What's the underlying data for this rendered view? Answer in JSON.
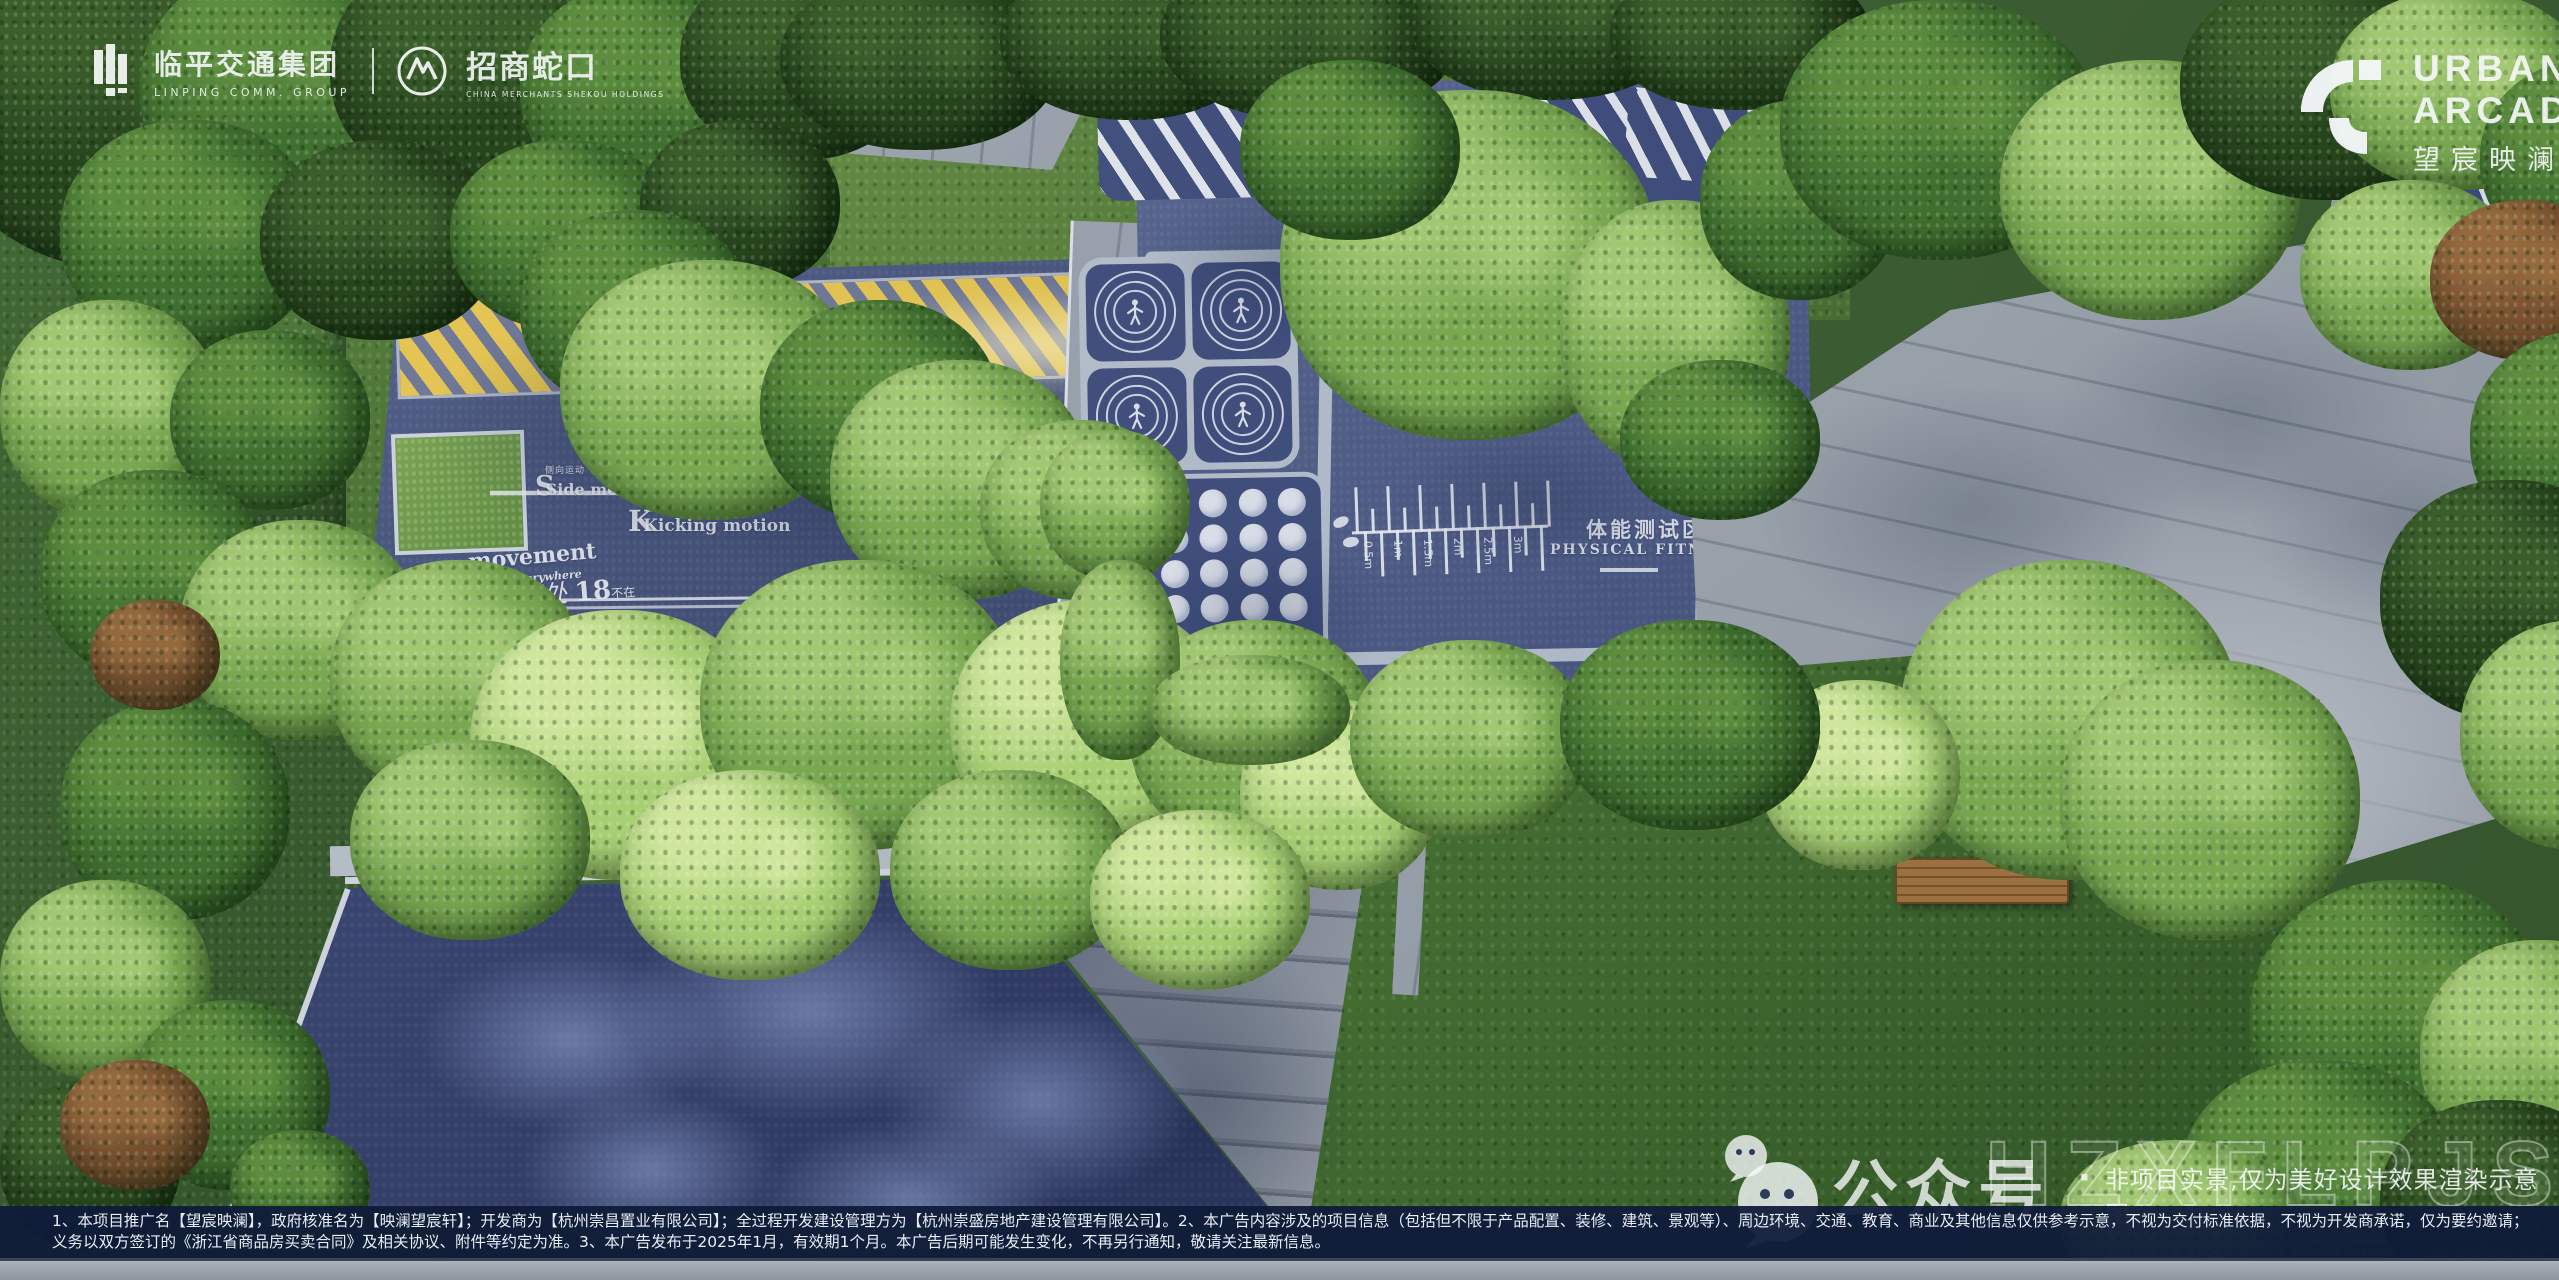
{
  "branding": {
    "linping": {
      "name": "临平交通集团",
      "tagline": "LINPING COMM. GROUP"
    },
    "cmsk": {
      "name": "招商蛇口",
      "tagline": "CHINA MERCHANTS SHEKOU HOLDINGS"
    },
    "project": {
      "en_line1": "URBAN",
      "en_line2": "ARCADIA",
      "cn": "望宸映澜"
    }
  },
  "track_markings": {
    "under_movement": {
      "en_line1": "Under",
      "en_line2": "movement"
    },
    "side_movement": {
      "cn": "侧向运动",
      "en": "Side movement"
    },
    "kicking_motion": {
      "cn": "踢腿运动",
      "en": "Kicking motion"
    },
    "movement_everywhere": {
      "en_line1": "movement",
      "en_line2": "everywhere",
      "cn_1": "运动",
      "cn_2": "无处",
      "accent": "18",
      "cn_3": "不在"
    }
  },
  "fitness_area": {
    "cn": "体能测试区",
    "en": "PHYSICAL FITNESS TEST",
    "ruler_labels": [
      "0.5m",
      "1m",
      "1.5m",
      "2m",
      "2.5m",
      "3m"
    ]
  },
  "watermark": {
    "account": "公众号",
    "separator": "·",
    "note": "非项目实景,仅为美好设计效果渲染示意图",
    "code": "HZXFLPJS"
  },
  "disclaimer": {
    "line1": "1、本项目推广名【望宸映澜】，政府核准名为【映澜望宸轩】；开发商为【杭州崇昌置业有限公司】；全过程开发建设管理方为【杭州崇盛房地产建设管理有限公司】。2、本广告内容涉及的项目信息（包括但不限于产品配置、装修、建筑、景观等）、周边环境、交通、教育、商业及其他信息仅供参考示意，不视为交付标准依据，不视为开发商承诺，仅为要约邀请；红线外的现状可能因政府规划等原因发生变更，最终以项目交付时的周边现状为准；买卖双方的权利",
    "line2": "义务以双方签订的《浙江省商品房买卖合同》及相关协议、附件等约定为准。3、本广告发布于2025年1月，有效期1个月。本广告后期可能发生变化，不再另行通知，敬请关注最新信息。"
  },
  "colors": {
    "track_blue": "#46547f",
    "panel_blue": "#3d4b7c",
    "plaza_navy": "#2a3560",
    "pavement_gray": "#9aa3ad",
    "stripe_yellow": "#e6c54d",
    "marking_white": "#eef2f8",
    "disclaimer_bar": "#101b39"
  }
}
